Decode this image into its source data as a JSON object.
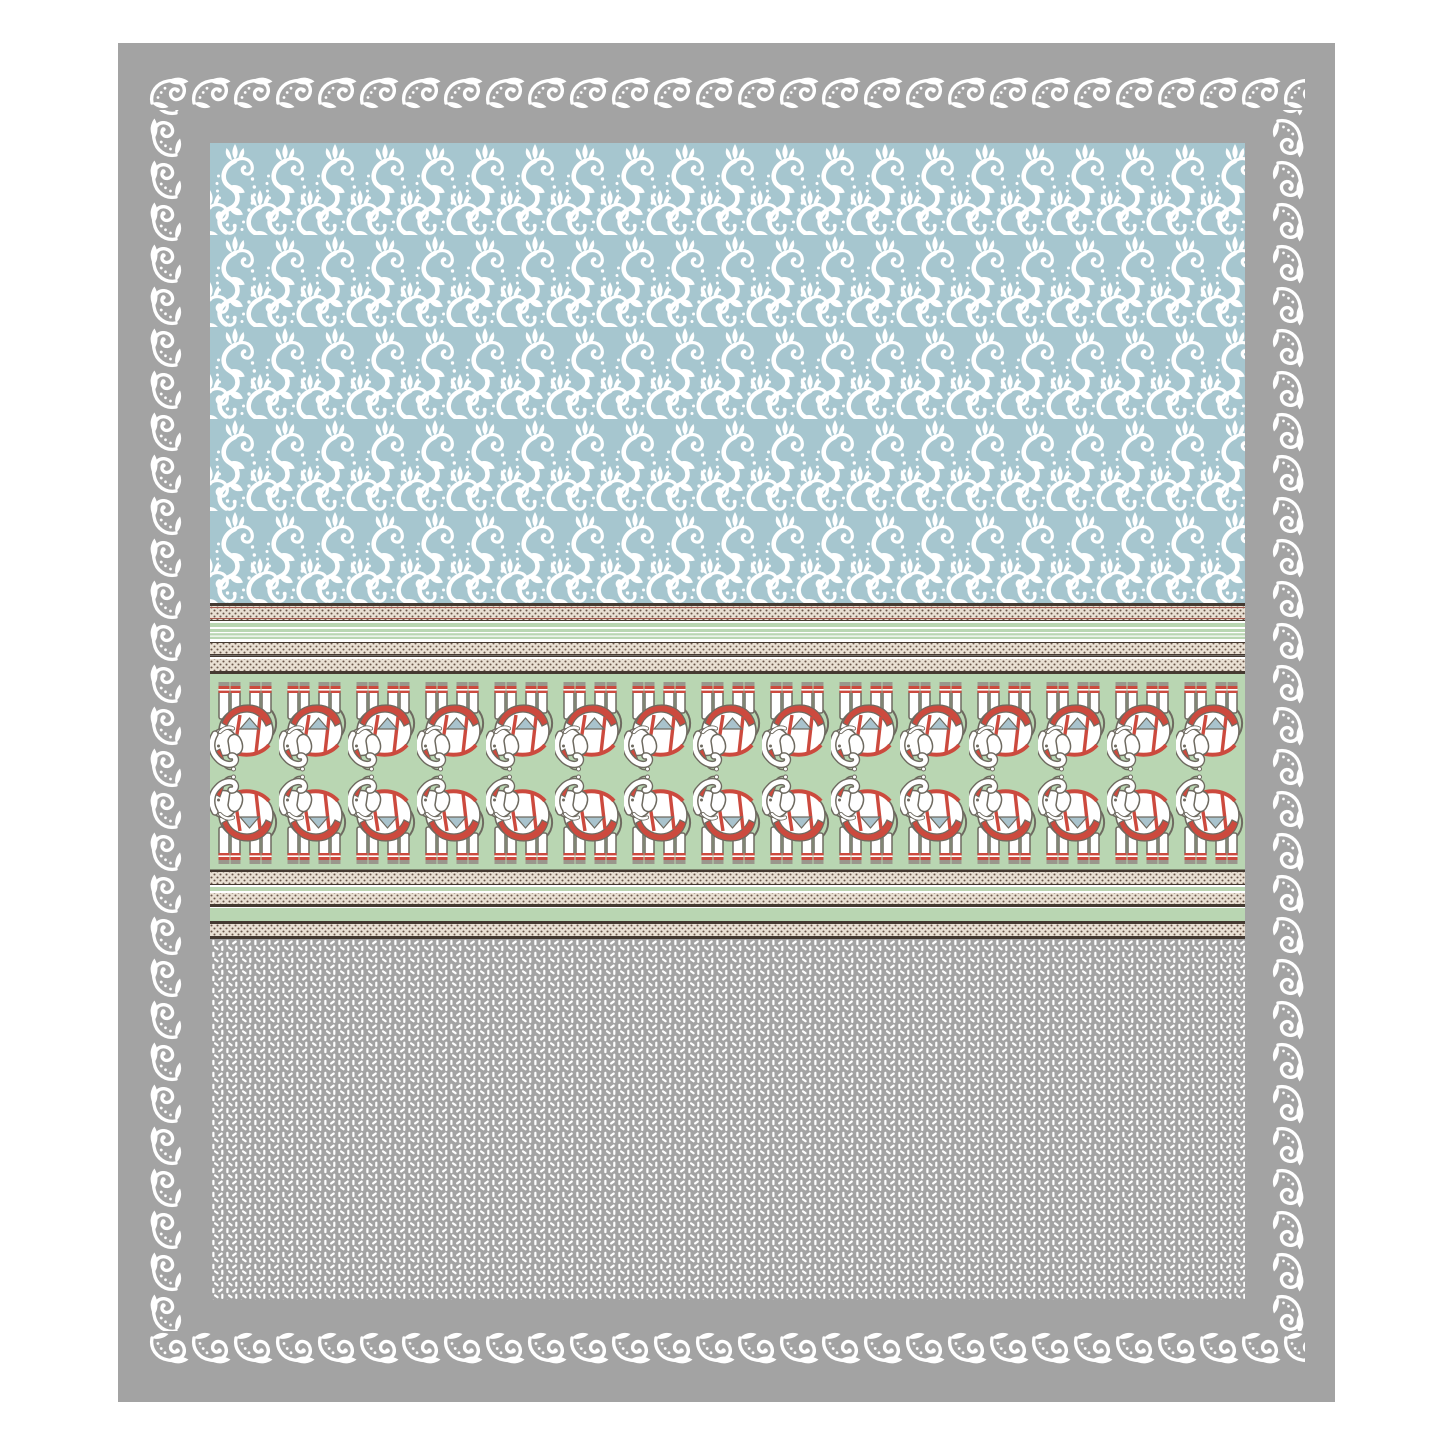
{
  "image": {
    "subject": "printed-bedsheet-flatlay",
    "style": "ethnic elephant damask print",
    "orientation": "top-down flat view"
  },
  "colors": {
    "page_bg": "#ffffff",
    "frame_gray": "#a3a3a3",
    "ornament_white": "#ffffff",
    "damask_blue": "#a6c6cf",
    "damask_white": "#ffffff",
    "leaf_green": "#b9d6b2",
    "green_pinstripe_white": "#ffffff",
    "stripe_cream": "#e9e0d3",
    "stripe_dot_brown": "#6a564a",
    "stripe_dark": "#453a31",
    "stripe_red": "#a55a4e",
    "band_white": "#ffffff",
    "elephant_white": "#ffffff",
    "elephant_outline": "#6e6a60",
    "elephant_red": "#cc4a3e",
    "elephant_blue": "#a9c3cd",
    "elephant_foot_gray": "#9a968c",
    "texture_gray": "#a3a3a3",
    "texture_mark_white": "#ffffff"
  },
  "pattern": {
    "outer_border": "white acanthus scroll ring on gray frame",
    "top_field": "white damask scrollwork on light blue",
    "middle_band": "caparisoned elephant frieze, two mirrored rows",
    "elephants_per_row": 15,
    "elephant_rows": 2,
    "bottom_field": "white seed/petal texture on gray",
    "divider_bands": "cream dotted tape stripes with green and red pin lines"
  }
}
